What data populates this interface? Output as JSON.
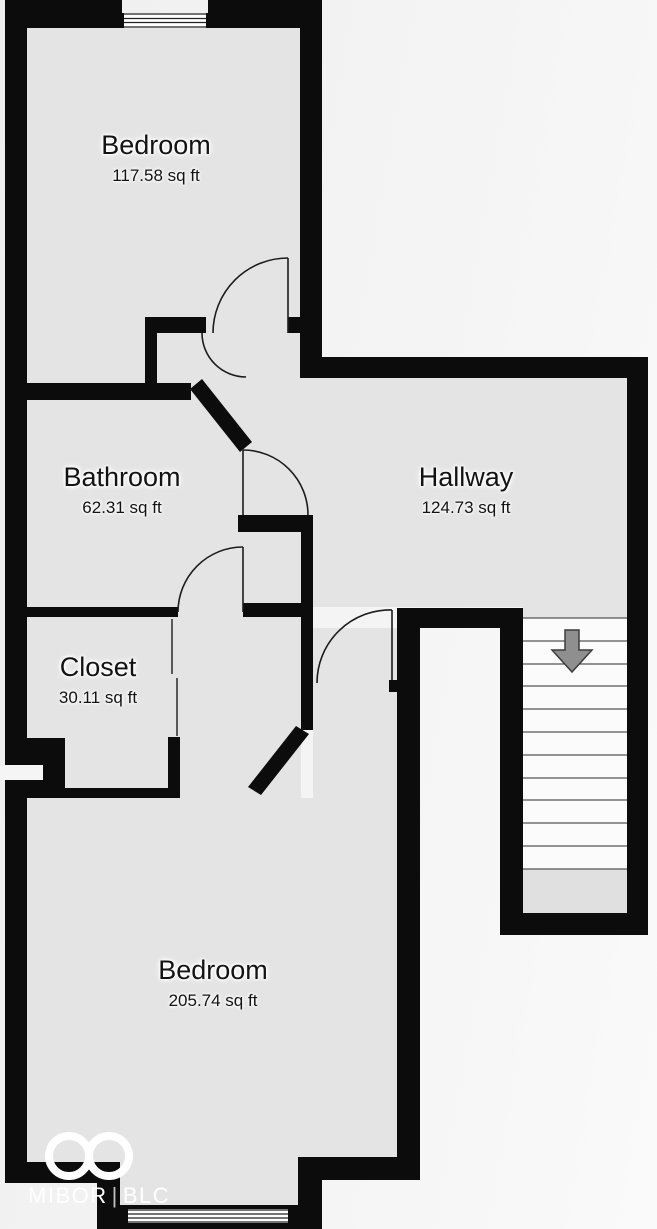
{
  "floorplan": {
    "rooms": [
      {
        "name": "Bedroom",
        "area": "117.58 sq ft"
      },
      {
        "name": "Bathroom",
        "area": "62.31 sq ft"
      },
      {
        "name": "Hallway",
        "area": "124.73 sq ft"
      },
      {
        "name": "Closet",
        "area": "30.11 sq ft"
      },
      {
        "name": "Bedroom",
        "area": "205.74 sq ft"
      }
    ],
    "stairs": {
      "steps": 11,
      "direction": "down"
    },
    "logo": {
      "brand": "MIBOR",
      "divider": "|",
      "suffix": "BLC"
    },
    "colors": {
      "wall": "#0c0c0c",
      "floor": "#e4e4e4",
      "outside": "#f5f5f5",
      "tread": "#fbfbfb",
      "landing": "#e0e0e0",
      "arrow_fill": "#8f8f8f",
      "arrow_stroke": "#3c3c3c",
      "line": "#1c1c1c",
      "label": "#131313"
    }
  }
}
